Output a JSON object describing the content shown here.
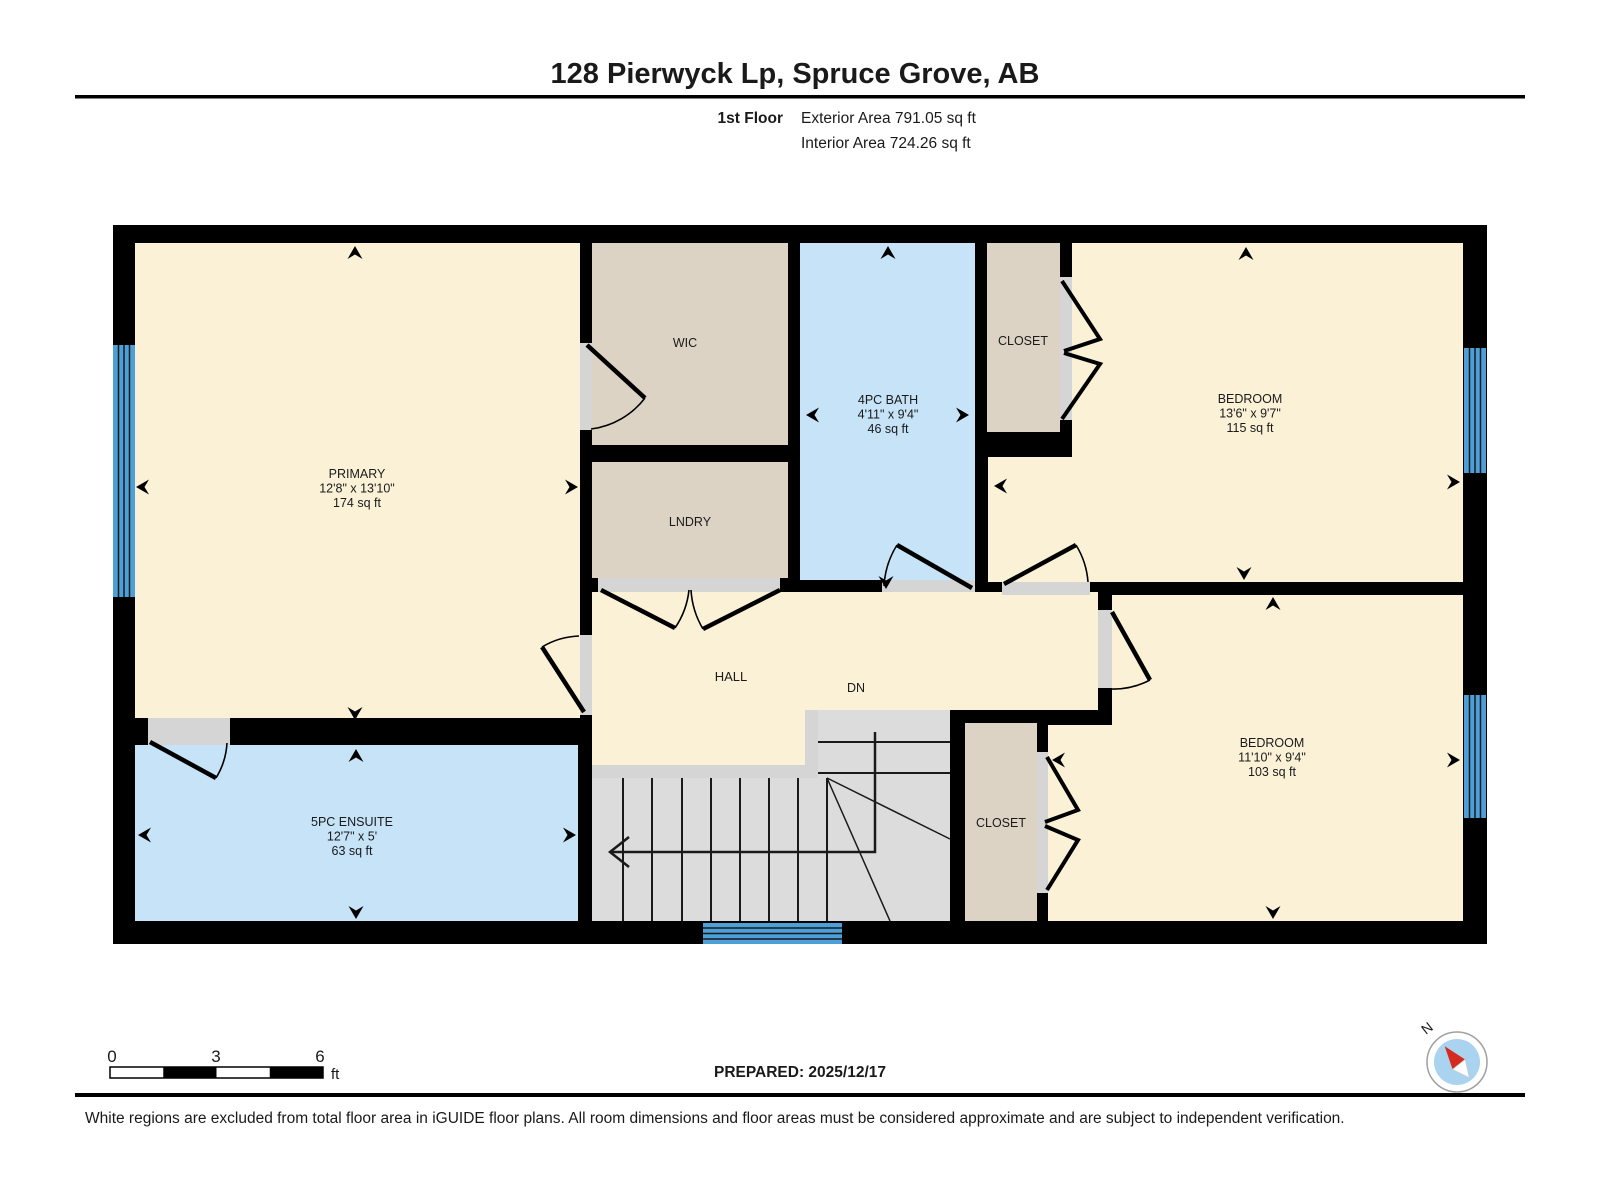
{
  "header": {
    "address": "128 Pierwyck Lp, Spruce Grove, AB",
    "floor_label": "1st Floor",
    "exterior_area": "Exterior Area 791.05 sq ft",
    "interior_area": "Interior Area 724.26 sq ft"
  },
  "rooms": {
    "primary": {
      "name": "PRIMARY",
      "dims": "12'8\" x 13'10\"",
      "area": "174 sq ft"
    },
    "wic": {
      "name": "WIC"
    },
    "laundry": {
      "name": "LNDRY"
    },
    "bath": {
      "name": "4PC BATH",
      "dims": "4'11\" x 9'4\"",
      "area": "46 sq ft"
    },
    "closet_top": {
      "name": "CLOSET"
    },
    "bedroom_top": {
      "name": "BEDROOM",
      "dims": "13'6\" x 9'7\"",
      "area": "115 sq ft"
    },
    "hall": {
      "name": "HALL"
    },
    "stairs": {
      "name": "DN"
    },
    "closet_bottom": {
      "name": "CLOSET"
    },
    "bedroom_bottom": {
      "name": "BEDROOM",
      "dims": "11'10\" x 9'4\"",
      "area": "103 sq ft"
    },
    "ensuite": {
      "name": "5PC ENSUITE",
      "dims": "12'7\" x 5'",
      "area": "63 sq ft"
    }
  },
  "scale_bar": {
    "tick_0": "0",
    "tick_3": "3",
    "tick_6": "6",
    "unit": "ft"
  },
  "footer": {
    "prepared": "PREPARED: 2025/12/17",
    "disclaimer": "White regions are excluded from total floor area in iGUIDE floor plans. All room dimensions and floor areas must be considered approximate and are subject to independent verification."
  },
  "compass": {
    "north_label": "N"
  },
  "colors": {
    "wall": "#000000",
    "room_cream": "#FAF1D6",
    "room_beige": "#DCD3C5",
    "room_blue": "#C6E3F7",
    "stairs_gray": "#DCDCDC",
    "threshold_gray": "#D5D5D5",
    "window_blue": "#4D9FD8",
    "compass_inner": "#A9D3EF",
    "needle_red": "#D42B1E"
  }
}
